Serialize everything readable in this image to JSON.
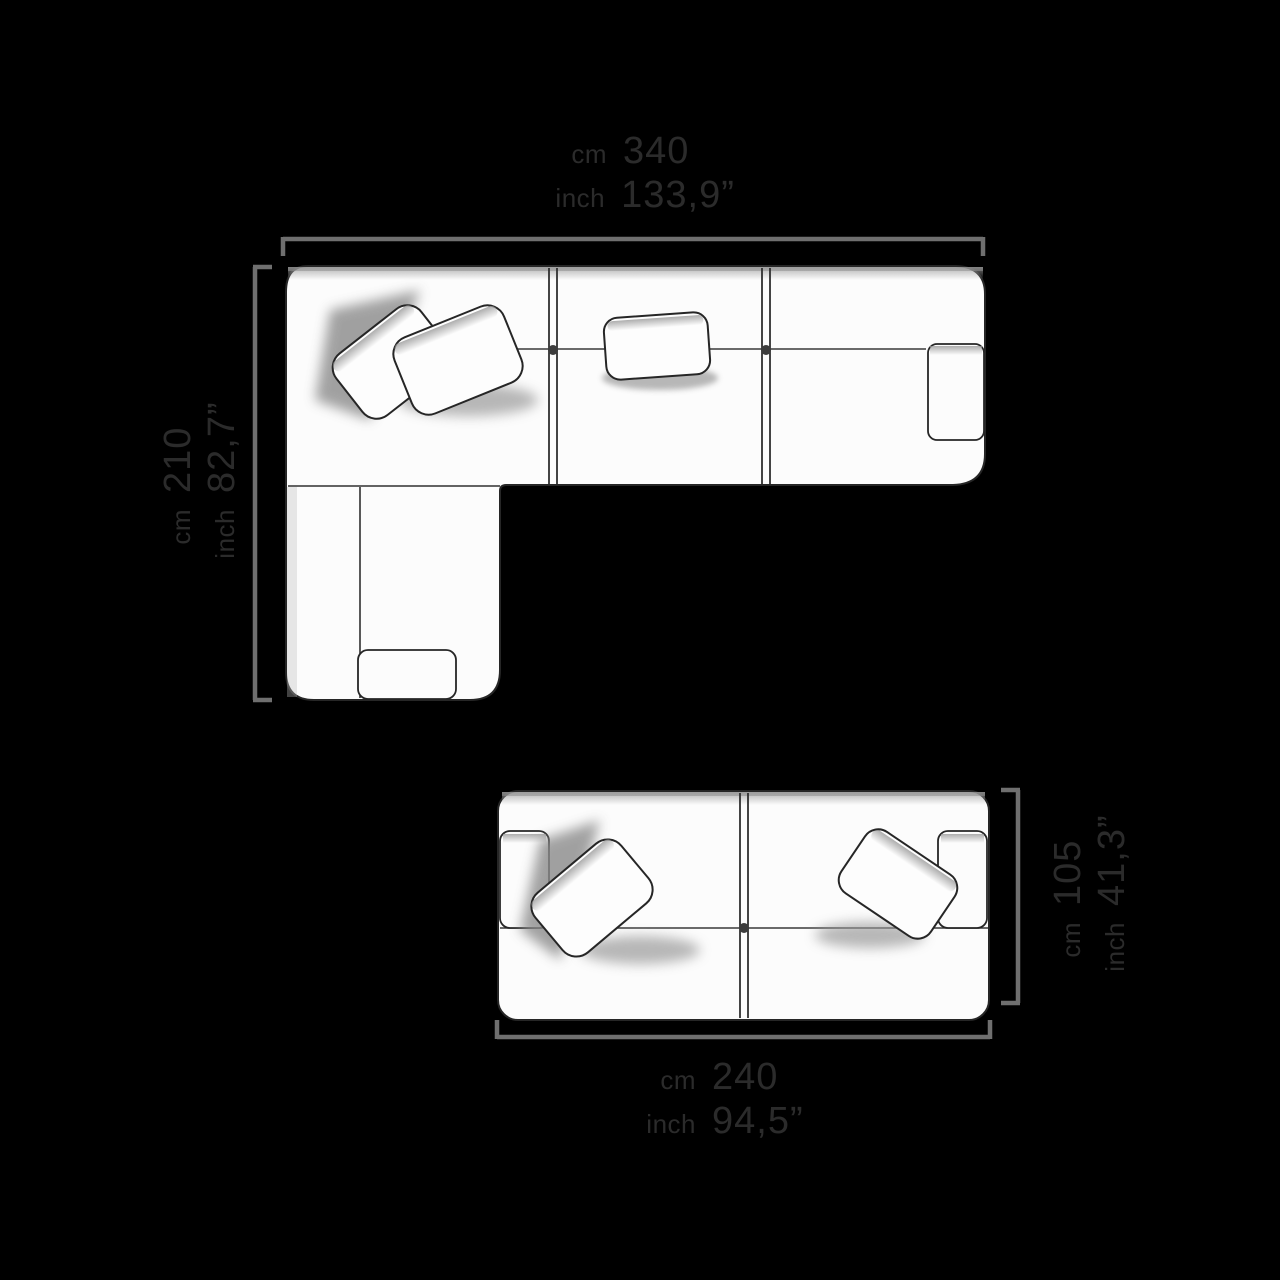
{
  "diagram": {
    "title": "sofa-dimensions-top-view",
    "units": {
      "cm": "cm",
      "inch": "inch"
    },
    "corner_sofa": {
      "name": "corner sofa with chaise, top view",
      "width": {
        "cm": "340",
        "inch": "133,9”"
      },
      "depth": {
        "cm": "210",
        "inch": "82,7”"
      }
    },
    "two_seat_sofa": {
      "name": "two seat sofa, top view",
      "width": {
        "cm": "240",
        "inch": "94,5”"
      },
      "depth": {
        "cm": "105",
        "inch": "41,3”"
      }
    },
    "colors": {
      "background": "#000000",
      "line_art": "#2e2e2e",
      "sofa_fill": "#fcfcfc",
      "dimension_line": "#6f6f6f",
      "label_text": "#2b2b2b"
    }
  }
}
